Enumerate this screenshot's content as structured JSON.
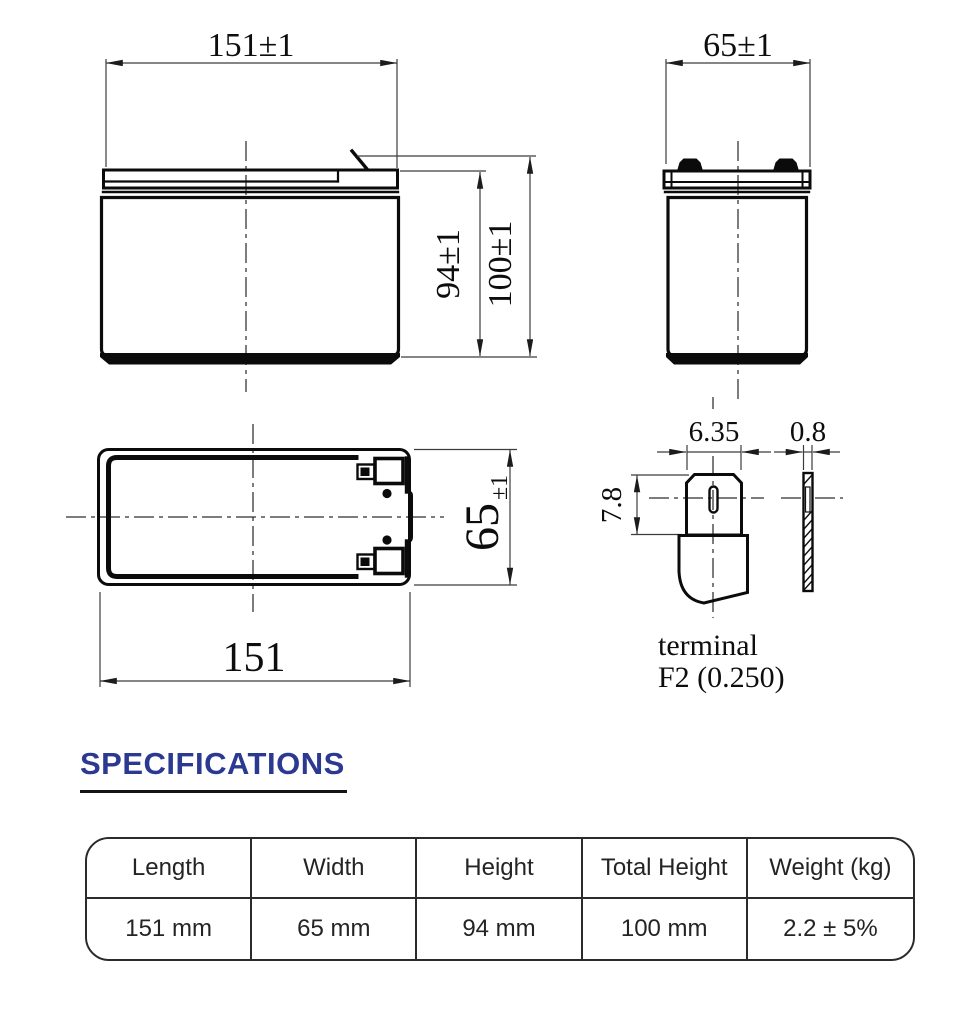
{
  "drawing": {
    "front_view": {
      "width_dim": "151±1",
      "height_dim": "94±1",
      "total_height_dim": "100±1"
    },
    "end_view": {
      "width_dim": "65±1"
    },
    "top_view": {
      "length_dim": "151",
      "width_dim": "65",
      "width_tol": "±1"
    },
    "terminal": {
      "width_dim": "6.35",
      "thickness_dim": "0.8",
      "height_dim": "7.8",
      "label": "terminal",
      "type": "F2 (0.250)"
    }
  },
  "specifications": {
    "heading": "SPECIFICATIONS",
    "table": {
      "headers": [
        "Length",
        "Width",
        "Height",
        "Total Height",
        "Weight (kg)"
      ],
      "values": [
        "151 mm",
        "65 mm",
        "94 mm",
        "100 mm",
        "2.2 ± 5%"
      ]
    }
  },
  "colors": {
    "accent": "#2b3990",
    "line": "#0b0b0b",
    "table_border": "#2b2b2b"
  }
}
